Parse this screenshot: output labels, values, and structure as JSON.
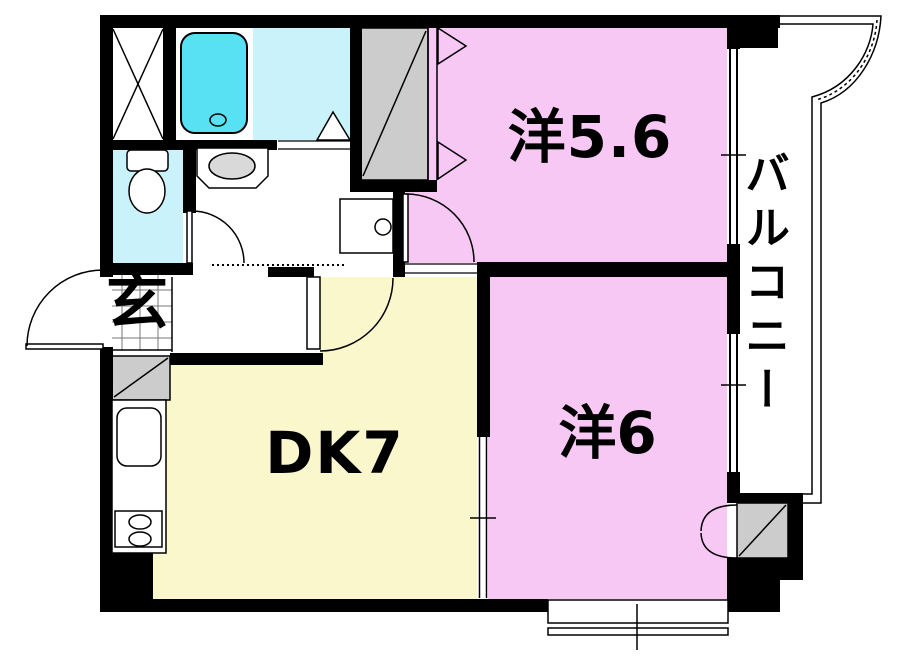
{
  "plan": {
    "type": "apartment-floorplan",
    "rooms": {
      "western_5_6": {
        "label": "洋5.6"
      },
      "western_6": {
        "label": "洋6"
      },
      "dining_kitchen": {
        "label": "DK7"
      },
      "entrance": {
        "label": "玄"
      },
      "balcony": {
        "label": "バルコニー"
      }
    },
    "colors": {
      "room_pink": "#f8c8f5",
      "dk_cream": "#fbf7cd",
      "wet_area_cyan": "#c9f2fa",
      "bathtub_cyan": "#58e1f2",
      "closet_gray": "#cccccc",
      "basin_gray": "#d9d9d9",
      "wall_black": "#000000"
    }
  }
}
